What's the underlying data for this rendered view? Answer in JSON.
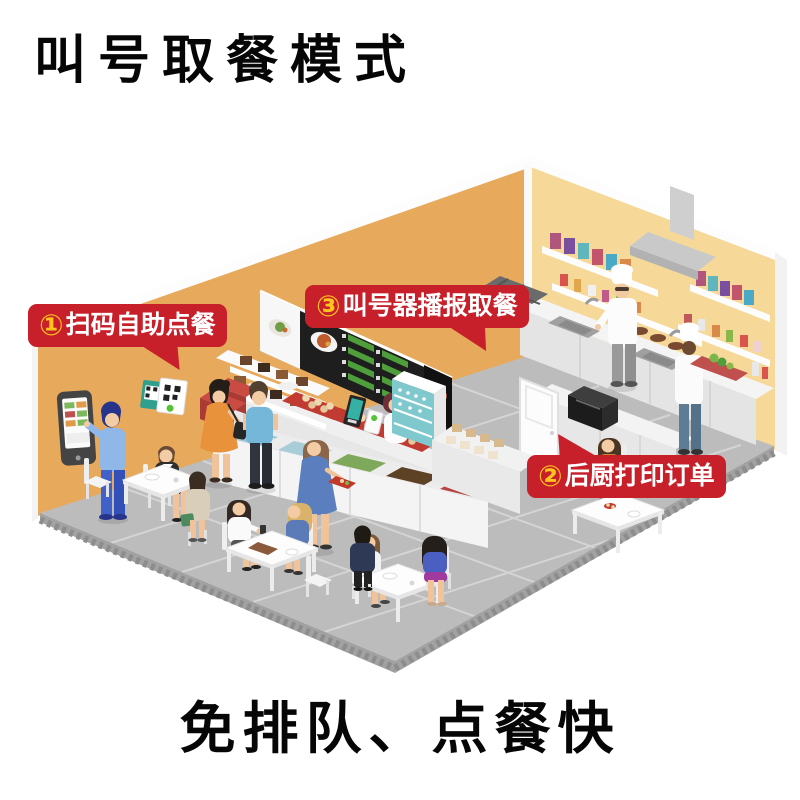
{
  "page": {
    "title": "叫号取餐模式",
    "caption": "免排队、点餐快"
  },
  "annotations": {
    "step1": {
      "number": "①",
      "label": "扫码自助点餐"
    },
    "step2": {
      "number": "②",
      "label": "后厨打印订单"
    },
    "step3": {
      "number": "③",
      "label": "叫号器播报取餐"
    }
  },
  "colors": {
    "bubble_background": "#c7202b",
    "bubble_text": "#ffffff",
    "bubble_number": "#ffc41e",
    "title_color": "#060606",
    "wall_dining": "#e7a95b",
    "wall_kitchen": "#f6d998",
    "wall_back": "#efc987",
    "window_blue": "#bfe4f2",
    "floor_gray": "#bcbcbc",
    "counter_white": "#f4f4f4",
    "tray_red": "#c23b33",
    "fridge_teal": "#7ec8ce"
  }
}
